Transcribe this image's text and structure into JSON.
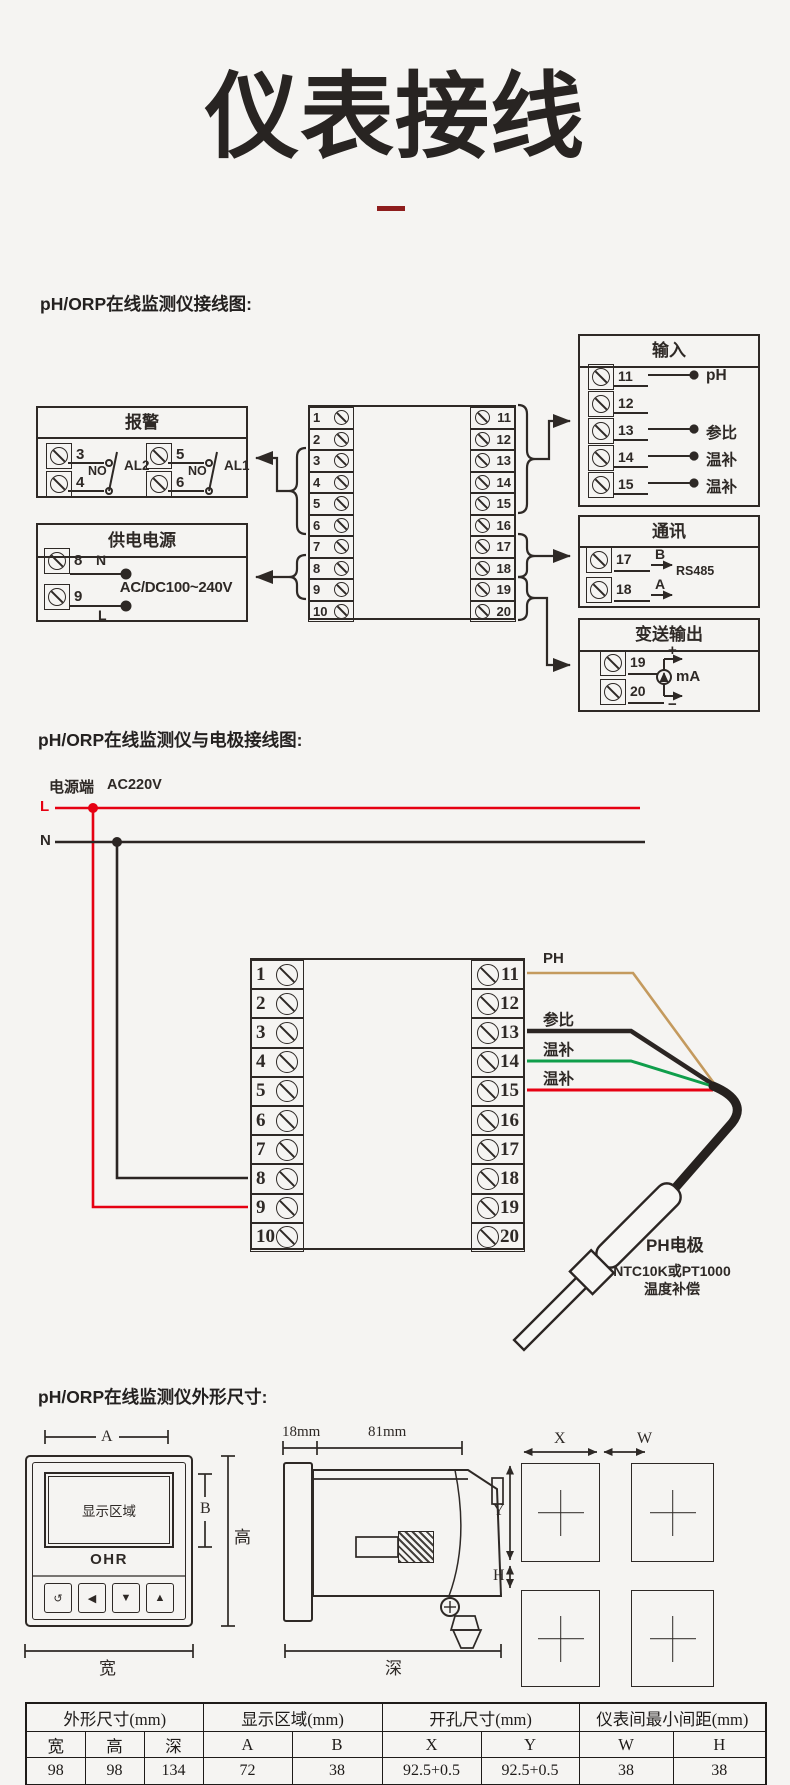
{
  "title": "仪表接线",
  "headings": {
    "h1": "pH/ORP在线监测仪接线图:",
    "h2": "pH/ORP在线监测仪与电极接线图:",
    "h3": "pH/ORP在线监测仪外形尺寸:"
  },
  "diagram1": {
    "left_terminals": [
      "1",
      "2",
      "3",
      "4",
      "5",
      "6",
      "7",
      "8",
      "9",
      "10"
    ],
    "right_terminals": [
      "11",
      "12",
      "13",
      "14",
      "15",
      "16",
      "17",
      "18",
      "19",
      "20"
    ],
    "alarm": {
      "title": "报警",
      "groups": [
        {
          "t1": "3",
          "t2": "4",
          "sw": "NO",
          "label": "AL2"
        },
        {
          "t1": "5",
          "t2": "6",
          "sw": "NO",
          "label": "AL1"
        }
      ]
    },
    "power": {
      "title": "供电电源",
      "t1": "8",
      "t2": "9",
      "neutral": "N",
      "live": "L",
      "voltage": "AC/DC100~240V"
    },
    "input": {
      "title": "输入",
      "rows": [
        {
          "t": "11",
          "label": "pH"
        },
        {
          "t": "12",
          "label": ""
        },
        {
          "t": "13",
          "label": "参比"
        },
        {
          "t": "14",
          "label": "温补"
        },
        {
          "t": "15",
          "label": "温补"
        }
      ]
    },
    "comm": {
      "title": "通讯",
      "t1": "17",
      "t2": "18",
      "b": "B",
      "a": "A",
      "protocol": "RS485"
    },
    "output": {
      "title": "变送输出",
      "t1": "19",
      "t2": "20",
      "plus": "+",
      "minus": "−",
      "unit": "mA"
    }
  },
  "diagram2": {
    "source_label": "电源端",
    "source_voltage": "AC220V",
    "live": "L",
    "neutral": "N",
    "left_terminals": [
      "1",
      "2",
      "3",
      "4",
      "5",
      "6",
      "7",
      "8",
      "9",
      "10"
    ],
    "right_terminals": [
      "11",
      "12",
      "13",
      "14",
      "15",
      "16",
      "17",
      "18",
      "19",
      "20"
    ],
    "wire_labels": {
      "ph": "PH",
      "ref": "参比",
      "temp1": "温补",
      "temp2": "温补"
    },
    "wire_colors": {
      "ph": "#c49a5e",
      "ref": "#2b2523",
      "temp1": "#0f9e4b",
      "temp2": "#e60012"
    },
    "electrode": {
      "name": "PH电极",
      "note1": "NTC10K或PT1000",
      "note2": "温度补偿"
    }
  },
  "dims": {
    "front": {
      "display": "显示区域",
      "logo": "OHR",
      "buttons": [
        "↺",
        "◀",
        "▼",
        "▲"
      ],
      "a": "A",
      "b": "B",
      "height": "高",
      "width": "宽"
    },
    "side": {
      "front_depth": "18mm",
      "body_depth": "81mm",
      "depth": "深"
    },
    "cutout": {
      "x": "X",
      "w": "W",
      "y": "Y",
      "h": "H"
    }
  },
  "table": {
    "groups": [
      {
        "label": "外形尺寸(mm)"
      },
      {
        "label": "显示区域(mm)"
      },
      {
        "label": "开孔尺寸(mm)"
      },
      {
        "label": "仪表间最小间距(mm)"
      }
    ],
    "headers": [
      "宽",
      "高",
      "深",
      "A",
      "B",
      "X",
      "Y",
      "W",
      "H"
    ],
    "values": [
      "98",
      "98",
      "134",
      "72",
      "38",
      "92.5+0.5",
      "92.5+0.5",
      "38",
      "38"
    ]
  },
  "colors": {
    "background": "#f5f4f2",
    "ink": "#2e2926",
    "accent_red": "#e60012",
    "title_underline": "#8e1d1d",
    "wire_tan": "#c49a5e",
    "wire_green": "#0f9e4b"
  }
}
